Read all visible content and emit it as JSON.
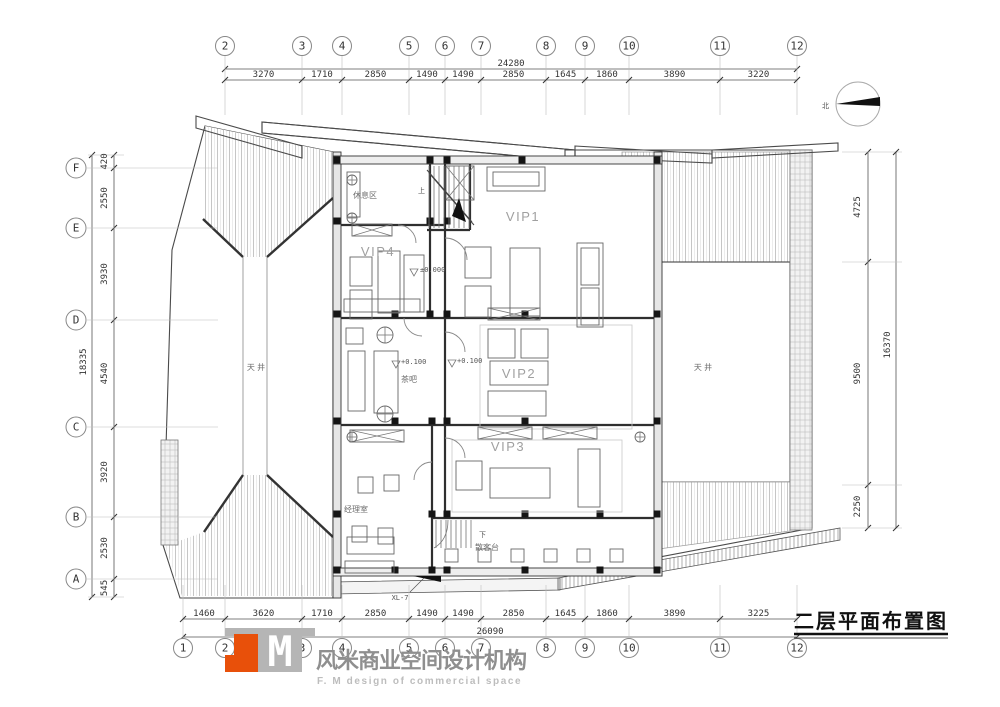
{
  "title": {
    "text": "二层平面布置图"
  },
  "north": {
    "label": "北"
  },
  "logo": {
    "m": "M",
    "cn": "风米商业空间设计机构",
    "en": "F. M design of commercial space",
    "orange": "#e8500a",
    "gray": "#b5b5b5"
  },
  "axes": {
    "top": {
      "labels": [
        "2",
        "3",
        "4",
        "5",
        "6",
        "7",
        "8",
        "9",
        "10",
        "11",
        "12"
      ],
      "dims": [
        "3270",
        "1710",
        "2850",
        "1490",
        "1490",
        "2850",
        "1645",
        "1860",
        "3890",
        "3220"
      ],
      "overall": "24280"
    },
    "bottom": {
      "labels": [
        "1",
        "2",
        "3",
        "4",
        "5",
        "6",
        "7",
        "8",
        "9",
        "10",
        "11",
        "12"
      ],
      "dims": [
        "1460",
        "3620",
        "1710",
        "2850",
        "1490",
        "1490",
        "2850",
        "1645",
        "1860",
        "3890",
        "3225"
      ],
      "overall": "26090"
    },
    "left": {
      "labels": [
        "F",
        "E",
        "D",
        "C",
        "B",
        "A"
      ],
      "dims": [
        "420",
        "2550",
        "3930",
        "4540",
        "3920",
        "2530",
        "545"
      ],
      "overall": "18335"
    },
    "right": {
      "dims": [
        "4725",
        "9500",
        "2250"
      ],
      "overall": "16370"
    }
  },
  "rooms": [
    {
      "name": "rest-area",
      "label": "休息区"
    },
    {
      "name": "vip1",
      "label": "VIP1"
    },
    {
      "name": "vip4",
      "label": "VIP4"
    },
    {
      "name": "tea-bar",
      "label": "茶吧"
    },
    {
      "name": "vip2",
      "label": "VIP2"
    },
    {
      "name": "vip3",
      "label": "VIP3"
    },
    {
      "name": "manager-office",
      "label": "经理室"
    },
    {
      "name": "walkin-counter",
      "label": "散客台"
    },
    {
      "name": "courtyard-left",
      "label": "天 井"
    },
    {
      "name": "courtyard-right",
      "label": "天 井"
    }
  ],
  "annotations": {
    "level0": "±0.000",
    "level1": "+0.100",
    "level2": "+0.100",
    "stair_up": "上",
    "stair_down": "下",
    "xl7": "XL-7"
  }
}
